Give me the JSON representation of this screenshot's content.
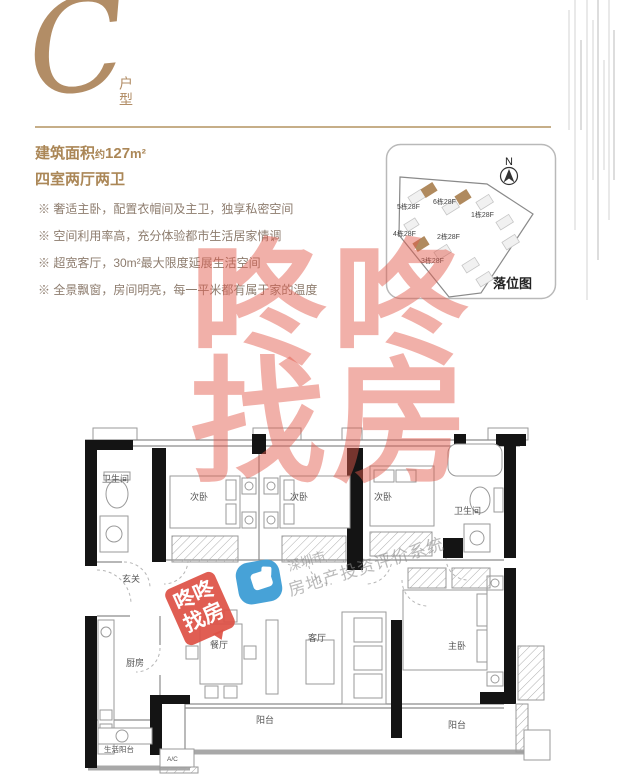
{
  "header": {
    "letter": "C",
    "type_label": "户型",
    "accent_color": "#b28d66"
  },
  "summary": {
    "area_label": "建筑面积",
    "area_approx": "约",
    "area_value": "127",
    "area_unit": "m²",
    "layout_text": "四室两厅两卫"
  },
  "features": {
    "items": [
      "※ 奢适主卧，配置衣帽间及主卫，独享私密空间",
      "※ 空间利用率高，充分体验都市生活居家情调",
      "※ 超宽客厅，30m²最大限度延展生活空间",
      "※ 全景飘窗，房间明亮，每一平米都有属于家的温度"
    ]
  },
  "siteplan": {
    "title": "落位图",
    "north_label": "N",
    "highlight_color": "#b08a5e",
    "buildings": [
      {
        "label": "5栋28F"
      },
      {
        "label": "6栋28F"
      },
      {
        "label": "1栋28F"
      },
      {
        "label": "4栋28F"
      },
      {
        "label": "2栋28F"
      },
      {
        "label": "3栋28F"
      }
    ]
  },
  "floorplan": {
    "labels": {
      "bath1": "卫生间",
      "bed1": "次卧",
      "bed2": "次卧",
      "bed3": "次卧",
      "bath2": "卫生间",
      "foyer": "玄关",
      "kitchen": "厨房",
      "dining": "餐厅",
      "living": "客厅",
      "master": "主卧",
      "balcony_main": "阳台",
      "balcony_master": "阳台",
      "service_balcony": "生活阳台",
      "ac": "A/C"
    }
  },
  "watermarks": {
    "big": {
      "line1": "咚咚",
      "line2": "找房",
      "color": "#e25a4b"
    },
    "stamp": {
      "line1": "咚咚",
      "line2": "找房",
      "bg": "#dd5a4e"
    },
    "gray": {
      "line1": "深圳市",
      "line2": "房地产投资评价系统"
    }
  }
}
